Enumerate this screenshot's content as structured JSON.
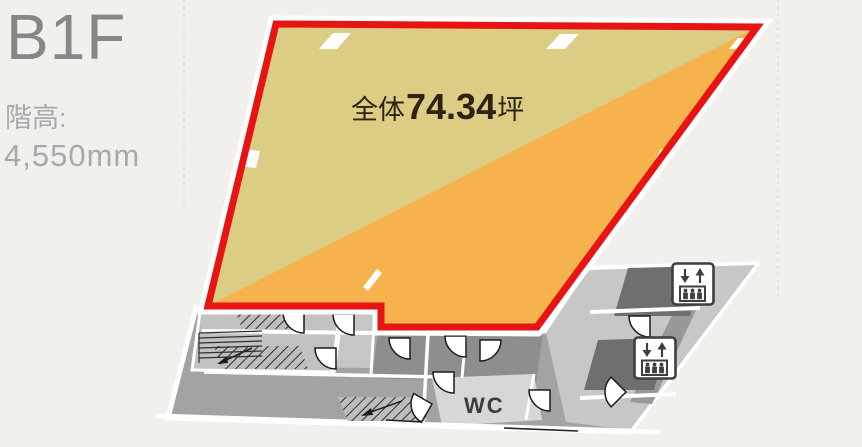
{
  "page": {
    "background": "#f2f0ec"
  },
  "header": {
    "floor": "B1F",
    "ceiling_label": "階高:",
    "ceiling_value": "4,550mm"
  },
  "highlight": {
    "label_prefix": "全体",
    "area_value": "74.34",
    "area_unit": "坪",
    "outline_color": "#e81413",
    "fill_upper": "#dccd85",
    "fill_lower": "#f6b24c"
  },
  "plan": {
    "wc_label": "WC",
    "floor_base_color": "#a3a3a3",
    "icons": {
      "elevator": "elevator-icon",
      "stairs": "stairs-hatching",
      "door": "door-swing-arc"
    }
  }
}
